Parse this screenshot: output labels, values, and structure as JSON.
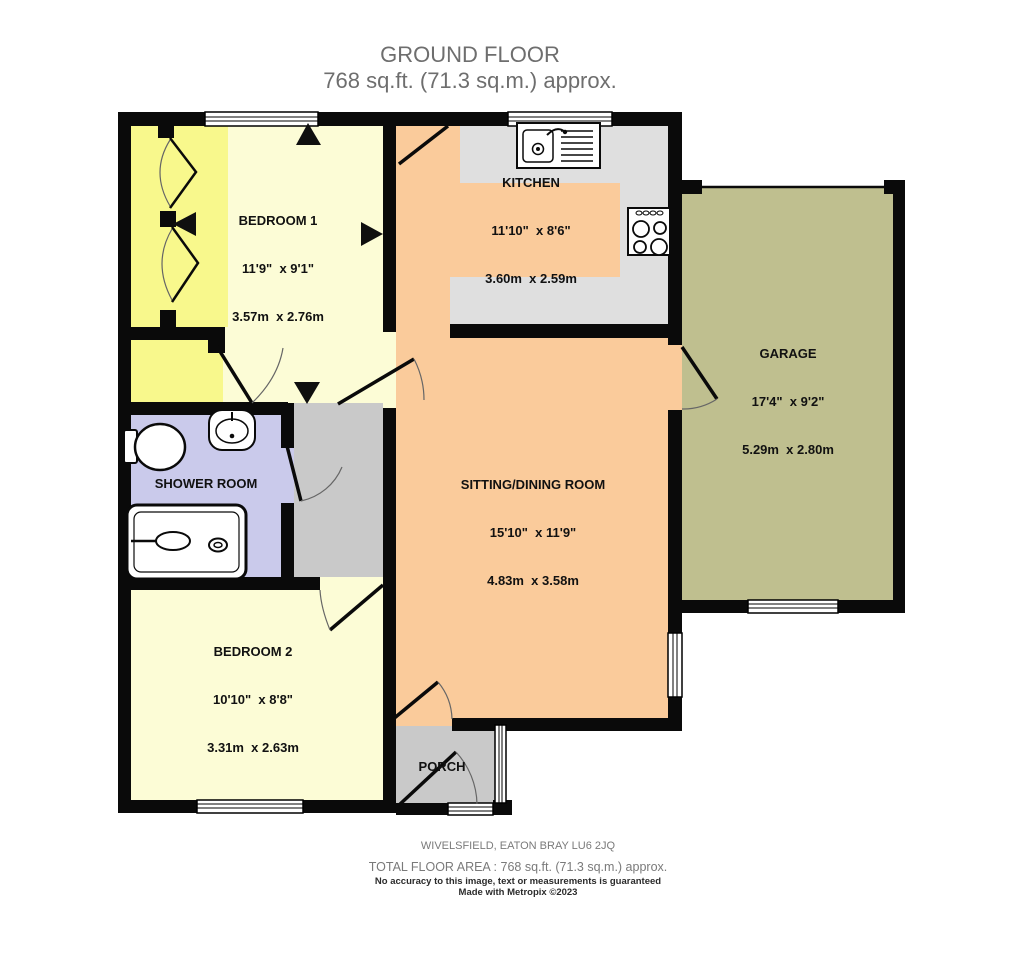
{
  "title": {
    "line1": "GROUND FLOOR",
    "line2": "768 sq.ft. (71.3 sq.m.) approx."
  },
  "rooms": {
    "bedroom1": {
      "name": "BEDROOM 1",
      "imperial": "11'9\"  x 9'1\"",
      "metric": "3.57m  x 2.76m"
    },
    "kitchen": {
      "name": "KITCHEN",
      "imperial": "11'10\"  x 8'6\"",
      "metric": "3.60m  x 2.59m"
    },
    "garage": {
      "name": "GARAGE",
      "imperial": "17'4\"  x 9'2\"",
      "metric": "5.29m  x 2.80m"
    },
    "sitting_dining": {
      "name": "SITTING/DINING ROOM",
      "imperial": "15'10\"  x 11'9\"",
      "metric": "4.83m  x 3.58m"
    },
    "shower": {
      "name": "SHOWER ROOM"
    },
    "bedroom2": {
      "name": "BEDROOM 2",
      "imperial": "10'10\"  x 8'8\"",
      "metric": "3.31m  x 2.63m"
    },
    "porch": {
      "name": "PORCH"
    }
  },
  "footer": {
    "address": "WIVELSFIELD, EATON BRAY LU6 2JQ",
    "total_area": "TOTAL FLOOR AREA : 768 sq.ft. (71.3 sq.m.) approx.",
    "disclaimer": "No accuracy to this image, text or measurements is guaranteed",
    "credit": "Made with Metropix ©2023"
  },
  "colors": {
    "wall": "#0a0a0a",
    "bedroom_floor": "#FCFCD6",
    "wardrobe_hall_yellow": "#F8F88C",
    "kitchen_sitting_floor": "#FACB9B",
    "garage_floor": "#BFBF8F",
    "shower_floor": "#CACAEB",
    "hall_porch_floor": "#C9C9C9",
    "worktop": "#DFDFDF"
  },
  "icons": [
    "kitchen-sink-icon",
    "stove-hob-icon",
    "toilet-icon",
    "basin-icon",
    "shower-tray-icon",
    "bifold-door-icon",
    "direction-arrow-icon",
    "window-icon",
    "door-swing-icon"
  ]
}
